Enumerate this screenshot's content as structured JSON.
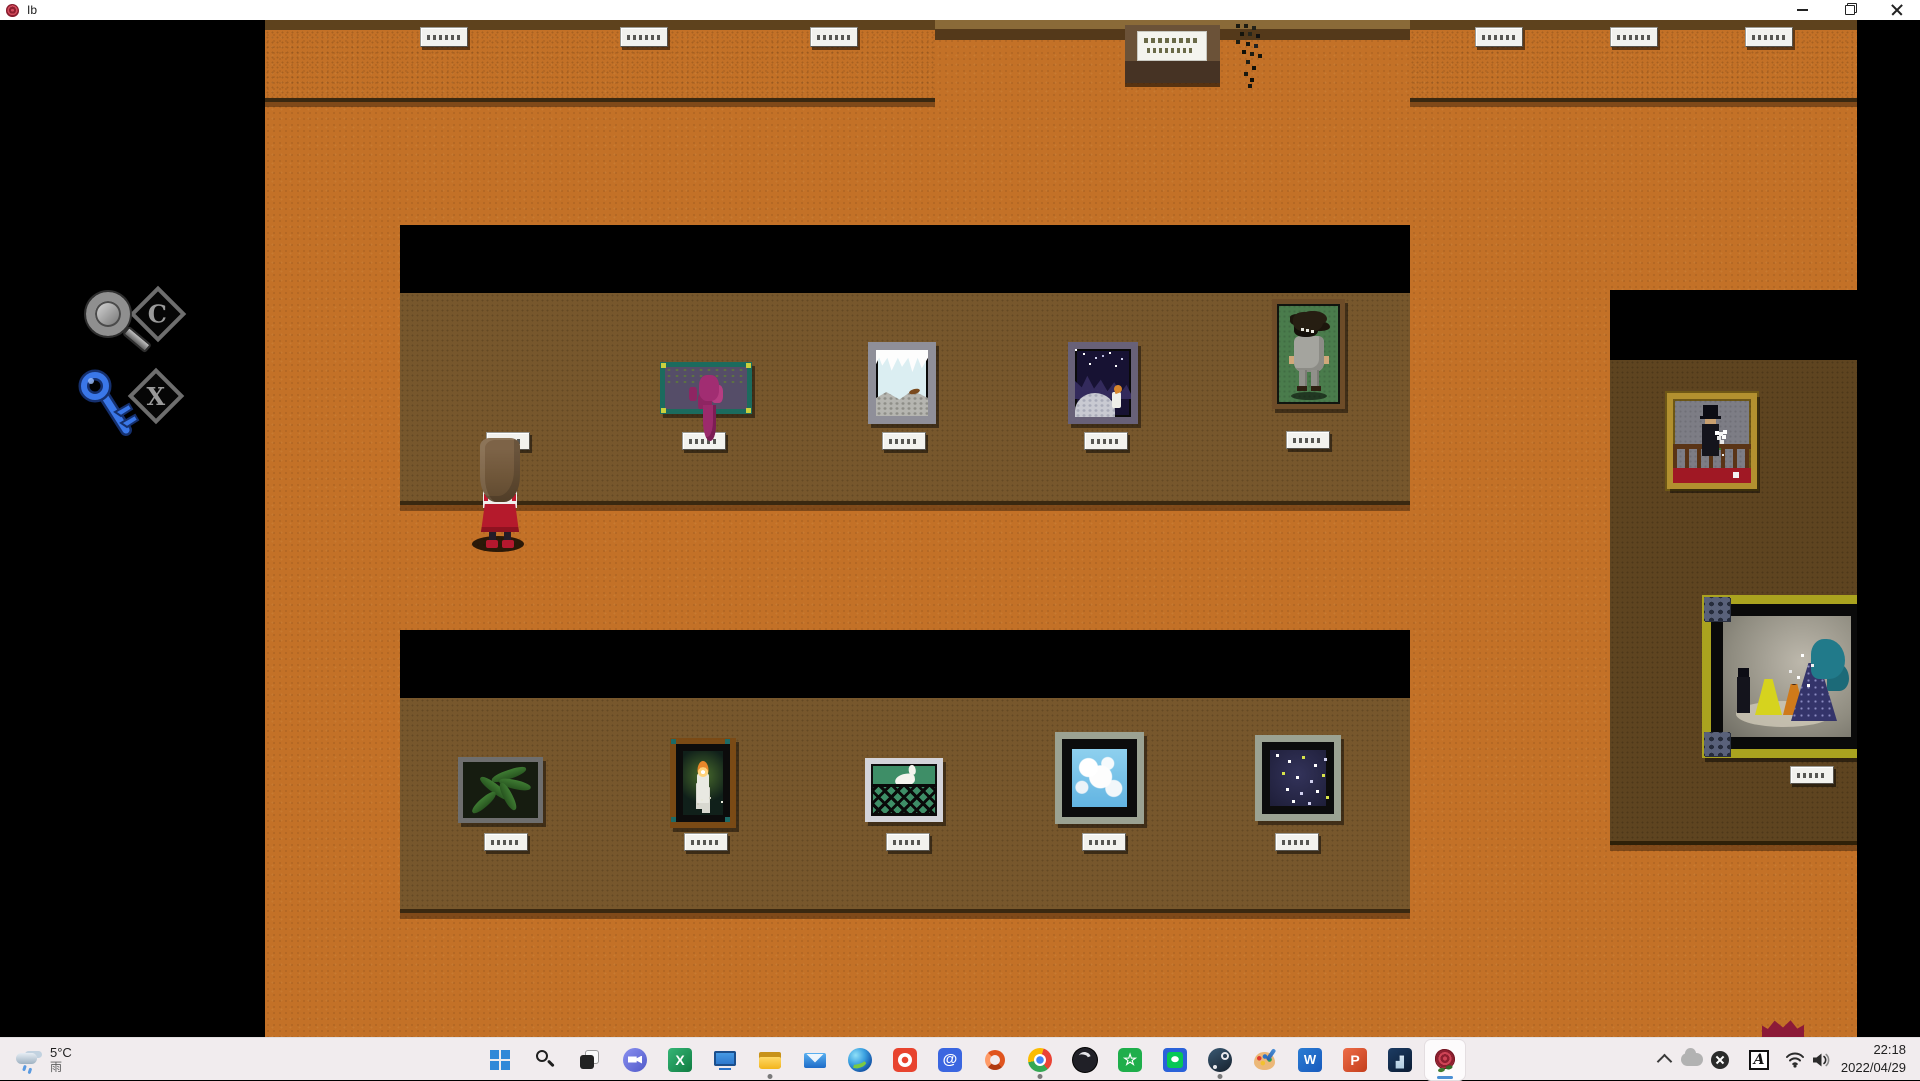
{
  "window": {
    "title": "Ib",
    "controls": [
      "minimize",
      "restore",
      "close"
    ]
  },
  "game": {
    "hint_buttons": [
      {
        "icon": "magnifier-icon",
        "label": "C"
      },
      {
        "icon": "key-icon",
        "label": "X"
      }
    ],
    "character": {
      "name": "ib",
      "hair_color": "#6f5639",
      "skirt_color": "#b51a2c"
    },
    "paintings": [
      {
        "name": "purple-cluster",
        "wall": "upper-gallery",
        "frame_color": "#1c6b5e"
      },
      {
        "name": "snowy-ruins",
        "wall": "upper-gallery",
        "frame_color": "#8f8f99"
      },
      {
        "name": "night-candle",
        "wall": "upper-gallery",
        "frame_color": "#686178"
      },
      {
        "name": "gray-clothed-figure",
        "wall": "upper-gallery",
        "frame_color": "#6d4c28"
      },
      {
        "name": "dark-leaves",
        "wall": "lower-gallery",
        "frame_color": "#6e6e6e"
      },
      {
        "name": "burning-candle",
        "wall": "lower-gallery",
        "frame_color": "#7a4a15"
      },
      {
        "name": "goose-behind-fence",
        "wall": "lower-gallery",
        "frame_color": "#d4d4da"
      },
      {
        "name": "blue-sky-clouds",
        "wall": "lower-gallery",
        "frame_color": "#9ba292"
      },
      {
        "name": "starry-night",
        "wall": "lower-gallery",
        "frame_color": "#9ba292"
      },
      {
        "name": "gentleman-with-bouquet",
        "wall": "right-room",
        "frame_color": "#b2902f"
      },
      {
        "name": "opera-scene",
        "wall": "right-room",
        "frame_color": "#aaa31f"
      }
    ],
    "plaques": {
      "count": 17,
      "text_legible": false
    },
    "sign_board": {
      "type": "message-board",
      "text_legible": false
    }
  },
  "taskbar": {
    "weather": {
      "temperature": "5°C",
      "condition": "雨"
    },
    "icons": [
      {
        "name": "start"
      },
      {
        "name": "search"
      },
      {
        "name": "task-view"
      },
      {
        "name": "chat"
      },
      {
        "name": "excel"
      },
      {
        "name": "monitor"
      },
      {
        "name": "file-explorer",
        "running": true
      },
      {
        "name": "mail"
      },
      {
        "name": "edge"
      },
      {
        "name": "red-app"
      },
      {
        "name": "at-app"
      },
      {
        "name": "office"
      },
      {
        "name": "chrome",
        "running": true
      },
      {
        "name": "obs"
      },
      {
        "name": "star-app"
      },
      {
        "name": "line"
      },
      {
        "name": "steam",
        "running": true
      },
      {
        "name": "paint"
      },
      {
        "name": "word"
      },
      {
        "name": "powerpoint"
      },
      {
        "name": "kindle"
      },
      {
        "name": "ib-game",
        "active": true
      }
    ],
    "tray": {
      "ime_label": "A",
      "time": "22:18",
      "date": "2022/04/29",
      "icons": [
        "tray-expand",
        "onedrive",
        "status-x",
        "ime",
        "wifi",
        "volume"
      ]
    }
  },
  "colors": {
    "title_bar": "#ffffff",
    "taskbar_bg": "#f1ecee",
    "floor": "#c37127",
    "wall": "#77572c",
    "accent_blue": "#4a8fd4",
    "rose_red": "#8e1f30"
  }
}
